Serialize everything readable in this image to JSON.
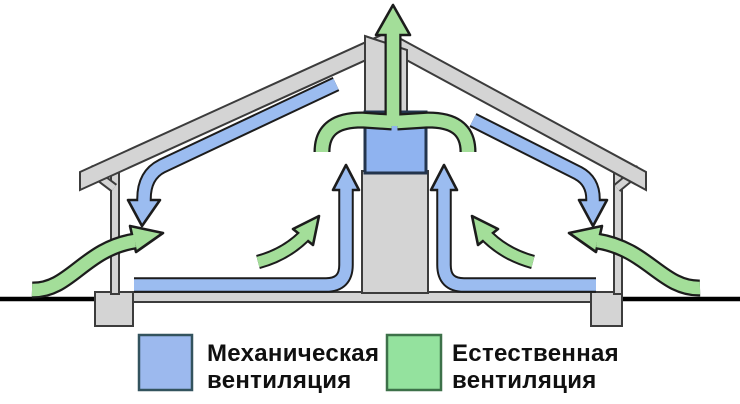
{
  "diagram": {
    "type": "house-ventilation-cross-section",
    "colors": {
      "mechanical_duct": "#9bbcf0",
      "natural_air": "#a3de99",
      "structure_gray": "#d4d4d4",
      "arrow_outline": "#1c1c1c",
      "fan_unit_fill": "#8fb3f0",
      "ground_line": "#000000"
    },
    "arrows": [
      {
        "name": "natural-exhaust-roof-outlet",
        "system": "natural",
        "direction": "up"
      },
      {
        "name": "natural-collector-left-branch",
        "system": "natural",
        "direction": "up-right"
      },
      {
        "name": "natural-collector-right-branch",
        "system": "natural",
        "direction": "up-left"
      },
      {
        "name": "natural-intake-left-wall",
        "system": "natural",
        "direction": "in-right"
      },
      {
        "name": "natural-intake-right-wall",
        "system": "natural",
        "direction": "in-left"
      },
      {
        "name": "natural-rise-left",
        "system": "natural",
        "direction": "up-right"
      },
      {
        "name": "natural-rise-right",
        "system": "natural",
        "direction": "up-left"
      },
      {
        "name": "mechanical-supply-left-slope",
        "system": "mechanical",
        "direction": "down"
      },
      {
        "name": "mechanical-supply-right-slope",
        "system": "mechanical",
        "direction": "down"
      },
      {
        "name": "mechanical-extract-left-riser",
        "system": "mechanical",
        "direction": "up"
      },
      {
        "name": "mechanical-extract-right-riser",
        "system": "mechanical",
        "direction": "up"
      }
    ]
  },
  "legend": {
    "items": [
      {
        "id": "mechanical",
        "line1": "Механическая",
        "line2": "вентиляция",
        "color": "#9cb9ee"
      },
      {
        "id": "natural",
        "line1": "Естественная",
        "line2": "вентиляция",
        "color": "#94e29e"
      }
    ]
  }
}
